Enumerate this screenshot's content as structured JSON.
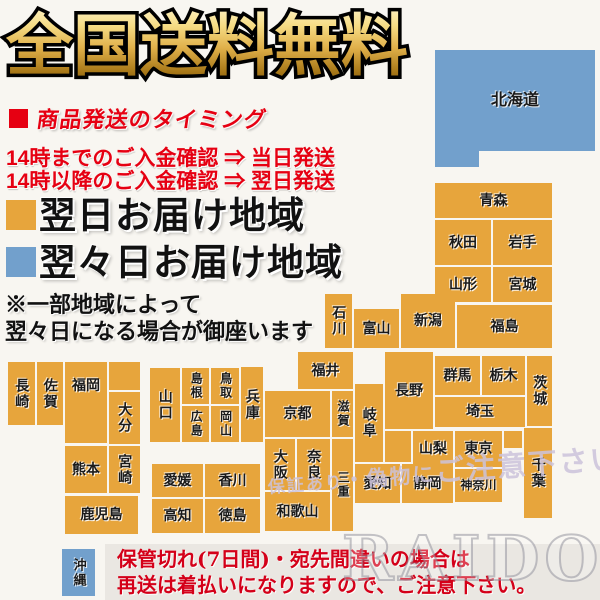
{
  "title": "全国送料無料",
  "shipping_timing": {
    "bullet_color": "#e60012",
    "heading": "商品発送のタイミング",
    "rule_before_14": "14時までのご入金確認 ⇒ 当日発送",
    "rule_after_14": "14時以降のご入金確認 ⇒ 翌日発送"
  },
  "legend": {
    "next_day": {
      "color": "#e7a53c",
      "label": "翌日お届け地域"
    },
    "two_days": {
      "color": "#72a0cc",
      "label": "翌々日お届け地域"
    }
  },
  "note": {
    "line1": "※一部地域によって",
    "line2": "翌々日になる場合が御座います"
  },
  "map": {
    "palette": {
      "next_day": "#e7a53c",
      "two_days": "#72a0cc"
    },
    "blocks": [
      {
        "name": "北海道",
        "x": 435,
        "y": 50,
        "w": 160,
        "h": 101,
        "color": "two_days",
        "orient": "h",
        "fs": 16
      },
      {
        "name": "",
        "x": 435,
        "y": 151,
        "w": 44,
        "h": 16,
        "color": "two_days",
        "orient": "h"
      },
      {
        "name": "青森",
        "x": 435,
        "y": 183,
        "w": 117,
        "h": 35,
        "color": "next_day",
        "orient": "h"
      },
      {
        "name": "秋田",
        "x": 435,
        "y": 220,
        "w": 56,
        "h": 45,
        "color": "next_day",
        "orient": "h"
      },
      {
        "name": "岩手",
        "x": 493,
        "y": 220,
        "w": 59,
        "h": 45,
        "color": "next_day",
        "orient": "h"
      },
      {
        "name": "山形",
        "x": 435,
        "y": 267,
        "w": 56,
        "h": 35,
        "color": "next_day",
        "orient": "h"
      },
      {
        "name": "宮城",
        "x": 493,
        "y": 267,
        "w": 59,
        "h": 35,
        "color": "next_day",
        "orient": "h"
      },
      {
        "name": "石川",
        "x": 325,
        "y": 294,
        "w": 27,
        "h": 54,
        "color": "next_day",
        "orient": "v"
      },
      {
        "name": "富山",
        "x": 354,
        "y": 309,
        "w": 45,
        "h": 39,
        "color": "next_day",
        "orient": "h"
      },
      {
        "name": "新潟",
        "x": 401,
        "y": 294,
        "w": 54,
        "h": 54,
        "color": "next_day",
        "orient": "h"
      },
      {
        "name": "福島",
        "x": 457,
        "y": 305,
        "w": 95,
        "h": 43,
        "color": "next_day",
        "orient": "h"
      },
      {
        "name": "福井",
        "x": 298,
        "y": 352,
        "w": 55,
        "h": 37,
        "color": "next_day",
        "orient": "h"
      },
      {
        "name": "長野",
        "x": 385,
        "y": 352,
        "w": 48,
        "h": 77,
        "color": "next_day",
        "orient": "h"
      },
      {
        "name": "群馬",
        "x": 435,
        "y": 356,
        "w": 45,
        "h": 39,
        "color": "next_day",
        "orient": "h"
      },
      {
        "name": "栃木",
        "x": 482,
        "y": 356,
        "w": 43,
        "h": 39,
        "color": "next_day",
        "orient": "h"
      },
      {
        "name": "茨城",
        "x": 527,
        "y": 356,
        "w": 25,
        "h": 70,
        "color": "next_day",
        "orient": "v"
      },
      {
        "name": "埼玉",
        "x": 435,
        "y": 397,
        "w": 90,
        "h": 30,
        "color": "next_day",
        "orient": "h"
      },
      {
        "name": "岐阜",
        "x": 355,
        "y": 384,
        "w": 28,
        "h": 78,
        "color": "next_day",
        "orient": "v"
      },
      {
        "name": "京都",
        "x": 265,
        "y": 391,
        "w": 65,
        "h": 46,
        "color": "next_day",
        "orient": "h"
      },
      {
        "name": "滋賀",
        "x": 332,
        "y": 391,
        "w": 21,
        "h": 46,
        "color": "next_day",
        "orient": "v",
        "fs": 12
      },
      {
        "name": "兵庫",
        "x": 241,
        "y": 367,
        "w": 22,
        "h": 75,
        "color": "next_day",
        "orient": "v"
      },
      {
        "name": "大阪",
        "x": 265,
        "y": 439,
        "w": 30,
        "h": 51,
        "color": "next_day",
        "orient": "v"
      },
      {
        "name": "奈良",
        "x": 297,
        "y": 439,
        "w": 33,
        "h": 51,
        "color": "next_day",
        "orient": "v"
      },
      {
        "name": "三重",
        "x": 332,
        "y": 439,
        "w": 21,
        "h": 92,
        "color": "next_day",
        "orient": "v",
        "fs": 12
      },
      {
        "name": "和歌山",
        "x": 265,
        "y": 492,
        "w": 65,
        "h": 39,
        "color": "next_day",
        "orient": "h"
      },
      {
        "name": "",
        "x": 385,
        "y": 431,
        "w": 26,
        "h": 31,
        "color": "next_day",
        "orient": "h"
      },
      {
        "name": "山梨",
        "x": 413,
        "y": 431,
        "w": 40,
        "h": 36,
        "color": "next_day",
        "orient": "h"
      },
      {
        "name": "東京",
        "x": 455,
        "y": 431,
        "w": 47,
        "h": 36,
        "color": "next_day",
        "orient": "h"
      },
      {
        "name": "",
        "x": 504,
        "y": 431,
        "w": 18,
        "h": 17,
        "color": "next_day",
        "orient": "h"
      },
      {
        "name": "千葉",
        "x": 524,
        "y": 428,
        "w": 28,
        "h": 90,
        "color": "next_day",
        "orient": "v"
      },
      {
        "name": "神奈川",
        "x": 455,
        "y": 469,
        "w": 47,
        "h": 33,
        "color": "next_day",
        "orient": "h",
        "fs": 12
      },
      {
        "name": "静岡",
        "x": 402,
        "y": 464,
        "w": 51,
        "h": 39,
        "color": "next_day",
        "orient": "h"
      },
      {
        "name": "愛知",
        "x": 355,
        "y": 464,
        "w": 45,
        "h": 39,
        "color": "next_day",
        "orient": "h"
      },
      {
        "name": "山口",
        "x": 150,
        "y": 368,
        "w": 30,
        "h": 74,
        "color": "next_day",
        "orient": "v"
      },
      {
        "name": "島根",
        "x": 182,
        "y": 368,
        "w": 27,
        "h": 36,
        "color": "next_day",
        "orient": "v",
        "fs": 12
      },
      {
        "name": "鳥取",
        "x": 211,
        "y": 368,
        "w": 28,
        "h": 36,
        "color": "next_day",
        "orient": "v",
        "fs": 12
      },
      {
        "name": "広島",
        "x": 182,
        "y": 406,
        "w": 27,
        "h": 36,
        "color": "next_day",
        "orient": "v",
        "fs": 12
      },
      {
        "name": "岡山",
        "x": 211,
        "y": 406,
        "w": 28,
        "h": 36,
        "color": "next_day",
        "orient": "v",
        "fs": 12
      },
      {
        "name": "愛媛",
        "x": 152,
        "y": 464,
        "w": 51,
        "h": 33,
        "color": "next_day",
        "orient": "h"
      },
      {
        "name": "香川",
        "x": 205,
        "y": 464,
        "w": 55,
        "h": 33,
        "color": "next_day",
        "orient": "h"
      },
      {
        "name": "高知",
        "x": 152,
        "y": 499,
        "w": 51,
        "h": 34,
        "color": "next_day",
        "orient": "h"
      },
      {
        "name": "徳島",
        "x": 205,
        "y": 499,
        "w": 55,
        "h": 34,
        "color": "next_day",
        "orient": "h"
      },
      {
        "name": "長崎",
        "x": 8,
        "y": 362,
        "w": 27,
        "h": 63,
        "color": "next_day",
        "orient": "v"
      },
      {
        "name": "佐賀",
        "x": 37,
        "y": 362,
        "w": 26,
        "h": 63,
        "color": "next_day",
        "orient": "v"
      },
      {
        "name": "福岡",
        "x": 65,
        "y": 362,
        "w": 42,
        "h": 81,
        "color": "next_day",
        "orient": "h",
        "align": "top"
      },
      {
        "name": "",
        "x": 109,
        "y": 362,
        "w": 31,
        "h": 28,
        "color": "next_day",
        "orient": "h"
      },
      {
        "name": "大分",
        "x": 109,
        "y": 392,
        "w": 31,
        "h": 52,
        "color": "next_day",
        "orient": "v"
      },
      {
        "name": "熊本",
        "x": 65,
        "y": 446,
        "w": 42,
        "h": 47,
        "color": "next_day",
        "orient": "h"
      },
      {
        "name": "宮崎",
        "x": 109,
        "y": 446,
        "w": 31,
        "h": 47,
        "color": "next_day",
        "orient": "v"
      },
      {
        "name": "鹿児島",
        "x": 65,
        "y": 496,
        "w": 73,
        "h": 38,
        "color": "next_day",
        "orient": "h"
      },
      {
        "name": "沖縄",
        "x": 62,
        "y": 549,
        "w": 33,
        "h": 47,
        "color": "two_days",
        "orient": "v",
        "fs": 13
      }
    ]
  },
  "watermarks": {
    "diagonal_part1": "保証あり",
    "diagonal_part2": "・偽物に",
    "diagonal_part3": "ご注意下さい",
    "brand": "RAIDOU"
  },
  "warning": {
    "line1": "保管切れ(7日間)・宛先間違いの場合は",
    "line2": "再送は着払いになりますので、ご注意下さい。"
  }
}
